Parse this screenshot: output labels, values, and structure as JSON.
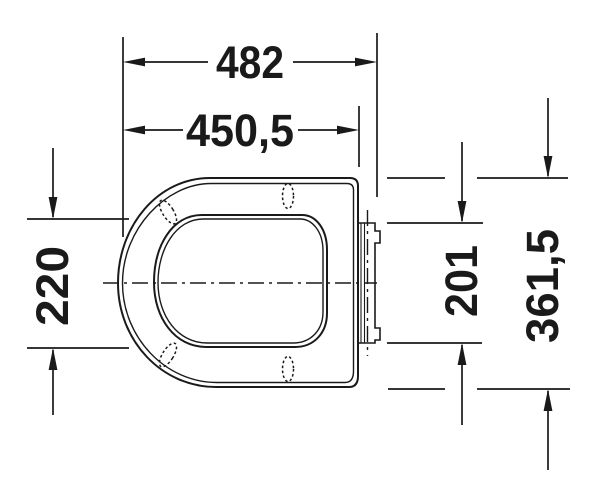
{
  "drawing": {
    "type": "technical-dimension-drawing",
    "subject": "toilet-seat-top-view"
  },
  "colors": {
    "line": "#1a1a1a",
    "background": "#ffffff"
  },
  "dimensions": {
    "total_length": {
      "value": "482",
      "orientation": "horizontal"
    },
    "lid_length": {
      "value": "450,5",
      "orientation": "horizontal"
    },
    "opening_width": {
      "value": "220",
      "orientation": "vertical"
    },
    "hinge_plate_width": {
      "value": "201",
      "orientation": "vertical"
    },
    "total_width": {
      "value": "361,5",
      "orientation": "vertical"
    }
  }
}
